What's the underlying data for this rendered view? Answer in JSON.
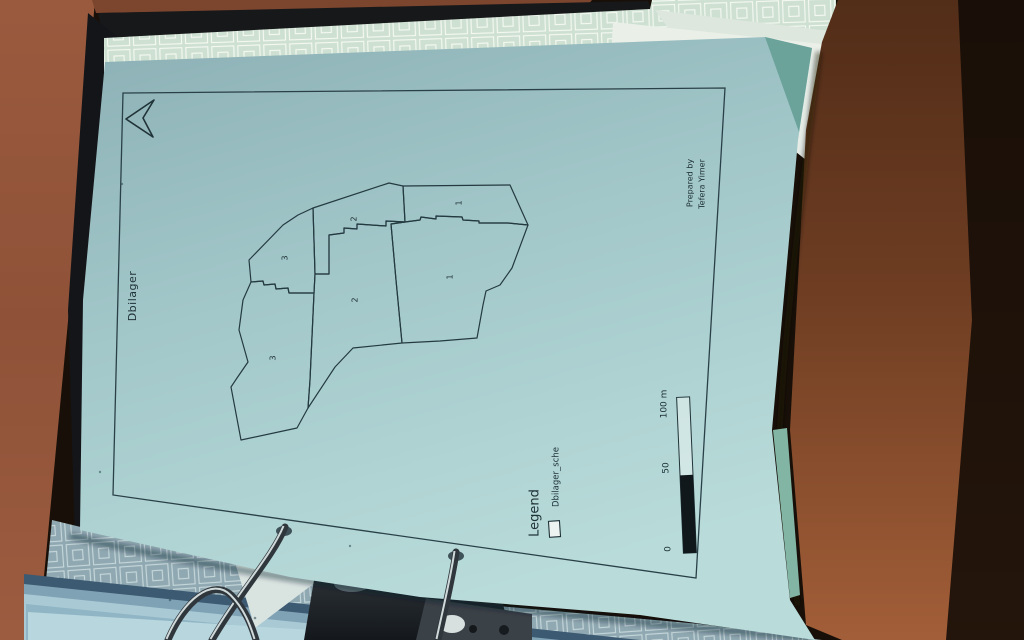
{
  "scene": {
    "description": "photographed paper map sheet clipped in a ring binder on a wooden desk"
  },
  "map_sheet": {
    "title": "Dbilager",
    "north_arrow": "north-arrow-icon",
    "parcel_labels": [
      "2",
      "1",
      "3",
      "2",
      "1",
      "3"
    ],
    "legend": {
      "heading": "Legend",
      "items": [
        {
          "symbol": "polygon-outline-swatch",
          "label": "Dbilager_sche"
        }
      ]
    },
    "scale_bar": {
      "labels": [
        "0",
        "50",
        "100 m"
      ]
    },
    "credit": {
      "line1": "Prepared by",
      "line2": "Tefera Yimer"
    }
  },
  "colors": {
    "sheet_teal": "#a2c7c9",
    "map_ink": "#203338",
    "desk_wood_left": "#9a5a3e",
    "desk_wood_right": "#6e3d22",
    "binder_black": "#17181a",
    "pattern_paper_green": "#cde0d1",
    "pattern_paper_shadow": "#8fa8b1",
    "scale_bar_fill": "#10181c",
    "ring_metal": "#30373c"
  }
}
